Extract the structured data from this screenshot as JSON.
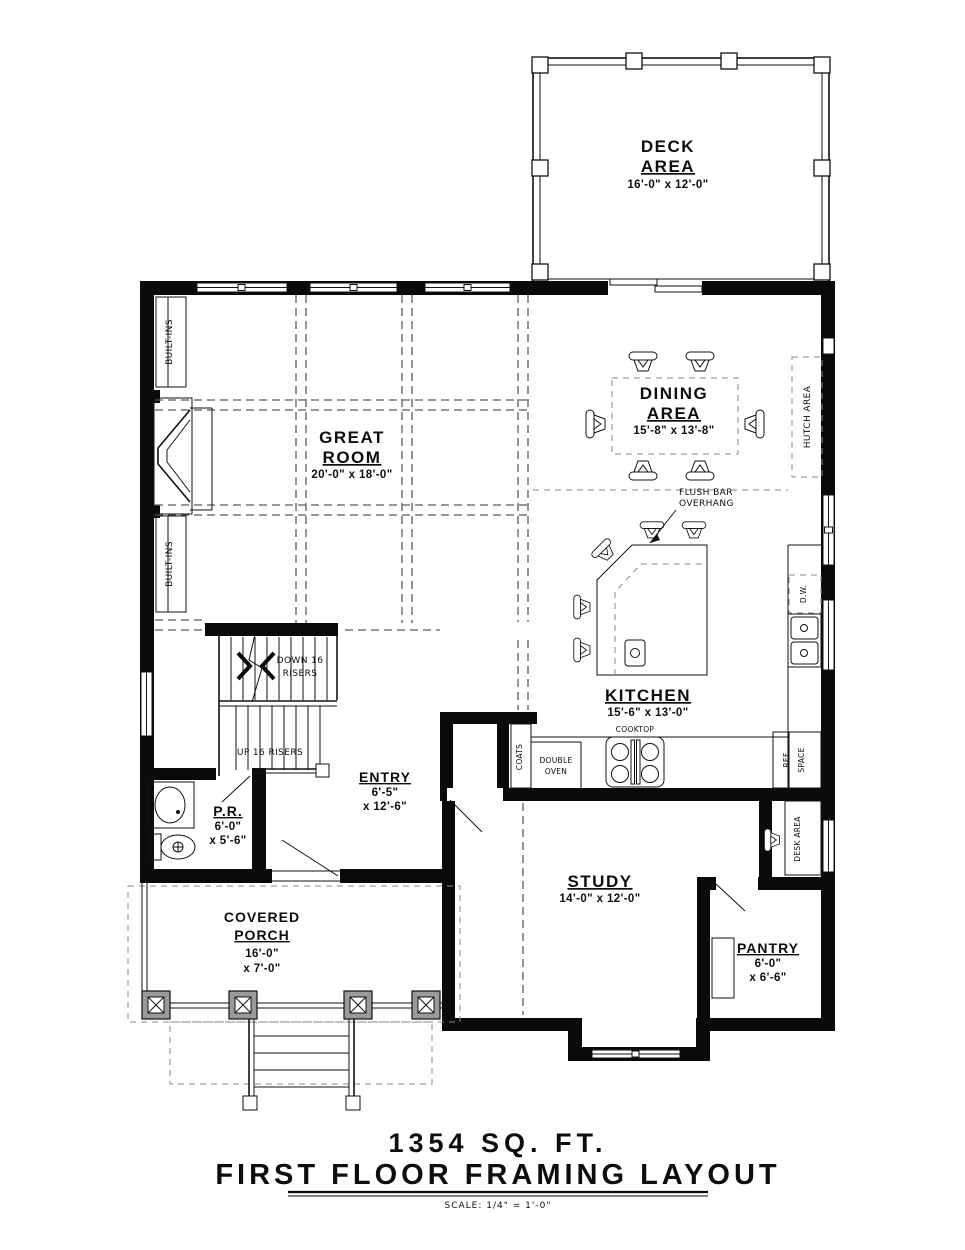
{
  "title": {
    "line1": "1354  SQ.  FT.",
    "line2": "FIRST  FLOOR  FRAMING  LAYOUT",
    "scale": "SCALE: 1/4\" = 1'-0\""
  },
  "rooms": {
    "deck": {
      "name1": "DECK",
      "name2": "AREA",
      "dims": "16'-0\" x 12'-0\""
    },
    "dining": {
      "name1": "DINING",
      "name2": "AREA",
      "dims": "15'-8\" x 13'-8\""
    },
    "great": {
      "name1": "GREAT",
      "name2": "ROOM",
      "dims": "20'-0\" x 18'-0\""
    },
    "kitchen": {
      "name1": "KITCHEN",
      "dims": "15'-6\" x 13'-0\""
    },
    "study": {
      "name1": "STUDY",
      "dims": "14'-0\" x 12'-0\""
    },
    "entry": {
      "name1": "ENTRY",
      "dim1": "6'-5\"",
      "dim2": "x 12'-6\""
    },
    "pr": {
      "name1": "P.R.",
      "dim1": "6'-0\"",
      "dim2": "x 5'-6\""
    },
    "porch": {
      "name1": "COVERED",
      "name2": "PORCH",
      "dim1": "16'-0\"",
      "dim2": "x 7'-0\""
    },
    "pantry": {
      "name1": "PANTRY",
      "dim1": "6'-0\"",
      "dim2": "x 6'-6\""
    }
  },
  "annotations": {
    "built_ins_top": "BUILT-INS",
    "built_ins_bottom": "BUILT-INS",
    "hutch": "HUTCH AREA",
    "flush_bar1": "FLUSH BAR",
    "flush_bar2": "OVERHANG",
    "down_risers1": "DOWN 16",
    "down_risers2": "RISERS",
    "up_risers": "UP 16 RISERS",
    "coats": "COATS",
    "double_oven1": "DOUBLE",
    "double_oven2": "OVEN",
    "cooktop": "COOKTOP",
    "dw": "D.W.",
    "ref1": "REF",
    "ref2": "SPACE",
    "desk": "DESK AREA"
  },
  "colors": {
    "wall": "#0a0a0a",
    "dashed_framing": "#5a5a5a",
    "paper": "#ffffff"
  }
}
